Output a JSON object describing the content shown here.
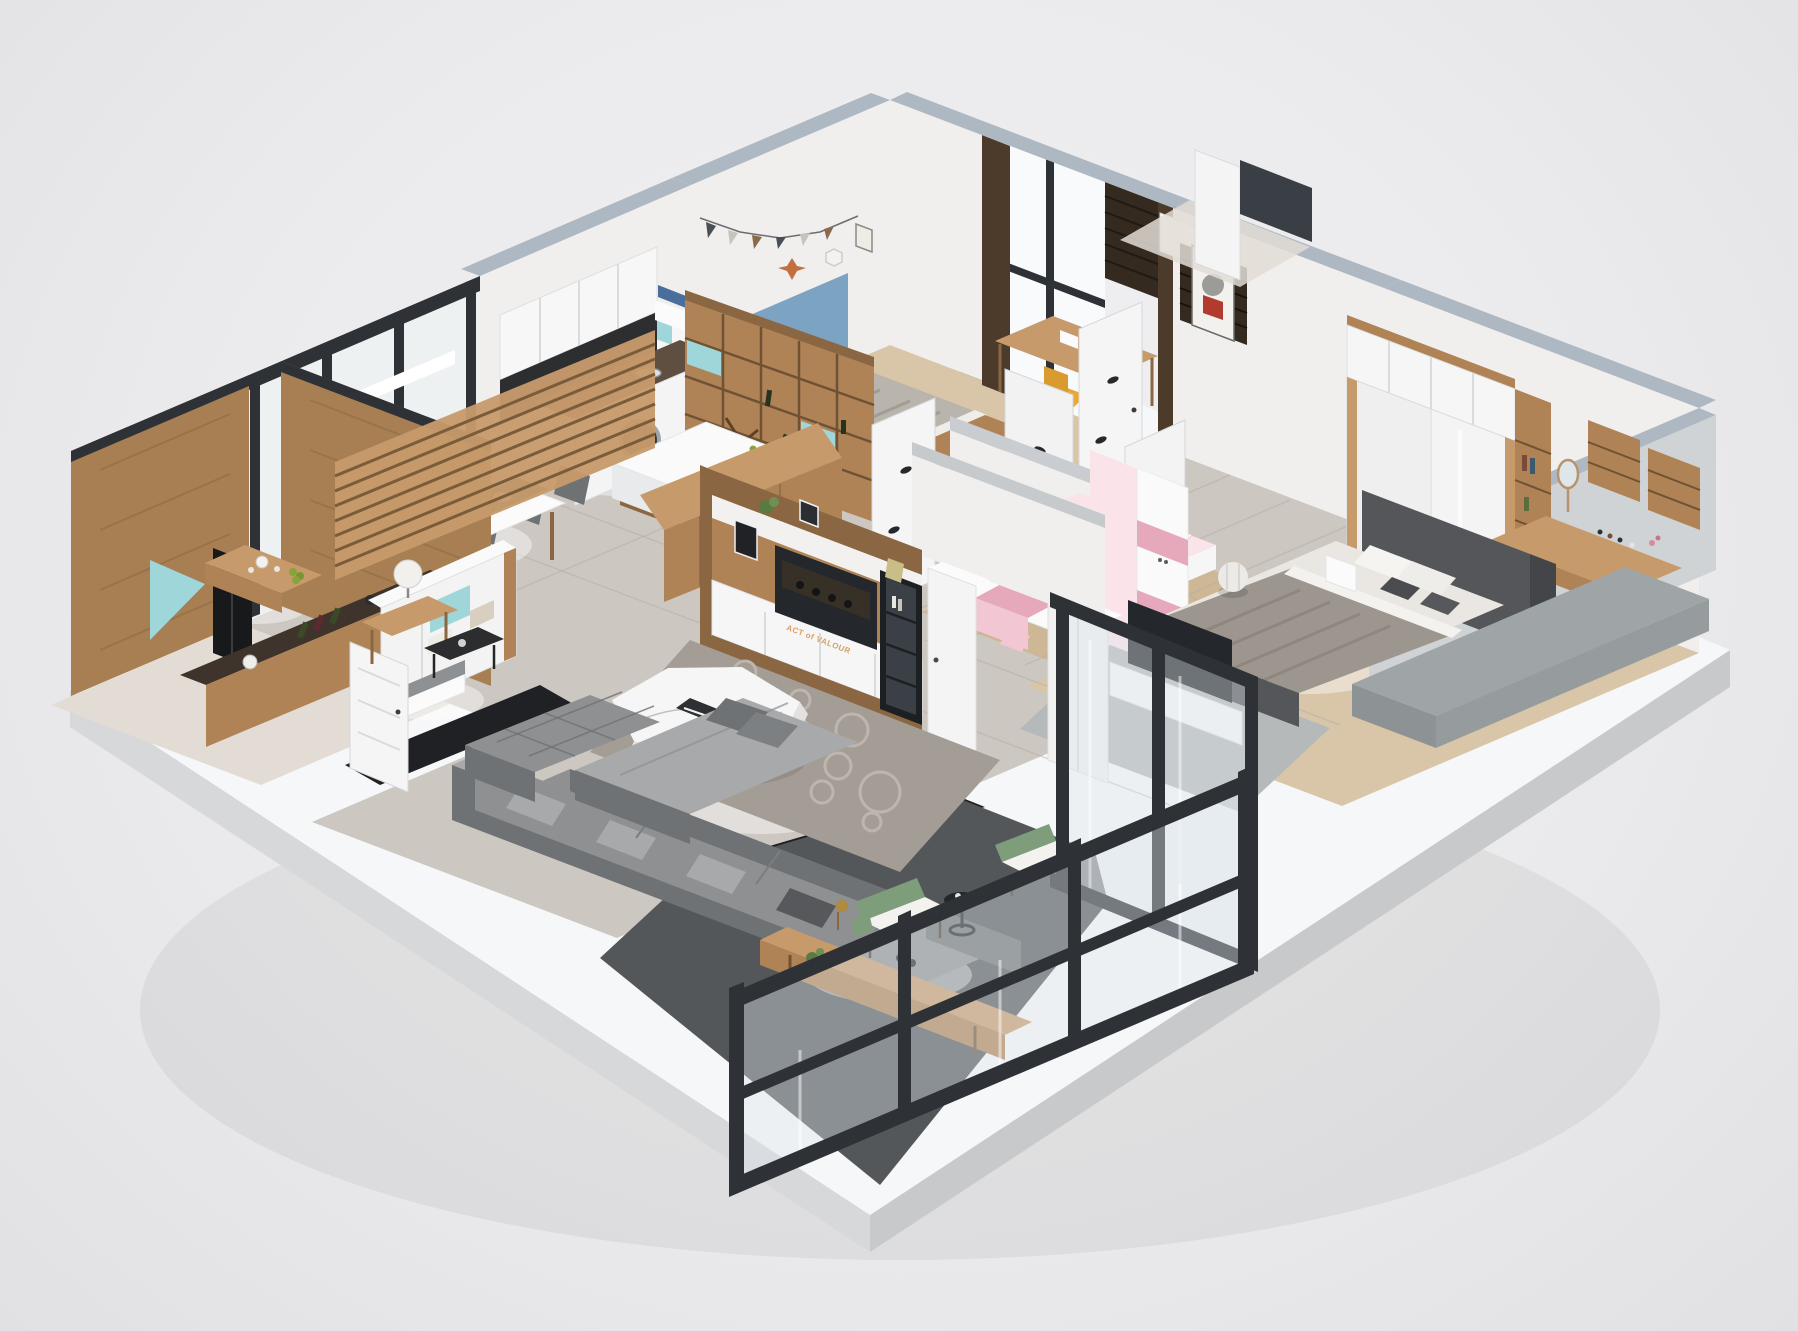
{
  "meta": {
    "type": "3d-isometric-apartment-floorplan-render",
    "view": "dollhouse cutaway, rotated isometric",
    "background": "light gray studio backdrop",
    "base": "white display platform slab"
  },
  "media": {
    "tv_poster_title": "ACT of VALOUR"
  },
  "palette": {
    "slab_top": "#f6f7f8",
    "slab_side": "#d6d8da",
    "slab_side_dark": "#c7c9cb",
    "wall_top": "#aeb8c2",
    "wall_white": "#f0efed",
    "wall_shadow": "#dfe1e3",
    "wood": "#b08356",
    "wood_light": "#c79a6b",
    "wood_dark": "#8a6742",
    "wood_deep": "#6e5234",
    "herringbone": "#a87f52",
    "marble": "#cdc7c1",
    "marble_light": "#e2dcd5",
    "woodfloor": "#d9c6a9",
    "woodfloor_dark": "#cdb795",
    "darktile": "#54575a",
    "blackmarble": "#1f2124",
    "frame_black": "#2e3237",
    "sofa": "#8e9092",
    "sofa_dark": "#6f7274",
    "sofa_light": "#a7a9ab",
    "rug": "#a49d96",
    "rug_light": "#beb6ae",
    "teal": "#9fd6da",
    "yellow": "#eaa832",
    "blue_headboard": "#7da3c2",
    "navy_runner": "#2f6b88",
    "pink": "#f3c6d3",
    "pink_dark": "#e6a9bc",
    "pink_light": "#fbe3ea",
    "green_chair": "#7e9d7b",
    "cushion_white": "#f3f2ee",
    "granite": "#5f4f41",
    "granite_dark": "#3e342b",
    "curtain": "#4c3b2b",
    "curtain_dark": "#352a1f",
    "tv_dark": "#24272b",
    "white": "#fdfdfd",
    "gray_bench": "#9fa4a6",
    "bed_frame": "#54565a",
    "bedding": "#eae7e2",
    "blanket": "#9c968e"
  },
  "rooms": [
    {
      "id": "small-bedroom",
      "label": "kids bedroom (blue & yellow)",
      "items": [
        "bed with blue headboard",
        "yellow pillows",
        "gray striped duvet",
        "wall bunting flags",
        "star ornament",
        "hexagon shelf",
        "picture frame",
        "study desk",
        "yellow chair",
        "rhino poster",
        "window with dark curtains",
        "roller blind",
        "white bookcase with teal cubbies"
      ]
    },
    {
      "id": "kitchen",
      "label": "kitchen / laundry",
      "items": [
        "granite counter with sink",
        "washing machine",
        "white upper cabinets",
        "stacked storage boxes",
        "cube shelving with X wine rack and bottles",
        "island bar with white top",
        "wine bottles",
        "green grapes",
        "wooden bar counter"
      ]
    },
    {
      "id": "dining-room",
      "label": "dining area",
      "items": [
        "white dining table",
        "teal-blue table runner",
        "six place settings",
        "six gray upholstered chairs with wood legs"
      ]
    },
    {
      "id": "tea-room",
      "label": "wood-paneled tea room",
      "items": [
        "herringbone wood wall panels",
        "hanging wood slat screens",
        "tea table with tea set and fruit",
        "black display cabinet",
        "stone-top counter with bottles and kettle",
        "teal accent panel"
      ]
    },
    {
      "id": "entry",
      "label": "entry",
      "items": [
        "front door",
        "shoe cabinet with teal cubby and boxes",
        "bench with gray cushion",
        "black marble threshold"
      ]
    },
    {
      "id": "hallway",
      "label": "hallway",
      "items": [
        "marble tile floor",
        "four white doors with black leaf decals"
      ]
    },
    {
      "id": "kids-bedroom-pink",
      "label": "kids bedroom (pink)",
      "items": [
        "white bed with pink Hello Kitty bedding",
        "Hello Kitty pillow",
        "pink and white wardrobe",
        "pink study desk with monitor",
        "pink cubby shelf",
        "floor mirror"
      ]
    },
    {
      "id": "master-bedroom",
      "label": "master bedroom",
      "items": [
        "upholstered platform bed",
        "layered gray and white bedding",
        "throw pillows",
        "sliding-door wardrobe with overhead cabinets",
        "corner dressing desk",
        "round vanity mirror",
        "cosmetics shelves",
        "bookshelf tower",
        "white pouf",
        "nightstand",
        "gray window bench platform",
        "TV on white cabinet",
        "white wardrobe",
        "gray rug",
        "light wood floor"
      ]
    },
    {
      "id": "living-room",
      "label": "living room",
      "items": [
        "gray sectional sofa with chaise",
        "tufted ottoman",
        "white marble coffee table",
        "circle-pattern rug",
        "wood side table with globe lamp",
        "black glass tray table",
        "wood console bench with brass lamp",
        "media wall with wood shelves and white cabinets",
        "poster screen",
        "black-framed display cabinet",
        "tall white cabinet",
        "potted plant",
        "photo frames"
      ]
    },
    {
      "id": "balcony",
      "label": "balcony",
      "items": [
        "black-framed glass partition walls",
        "dark tile floor",
        "black marble border",
        "two green armchairs with white cushions",
        "round black side table"
      ]
    }
  ]
}
